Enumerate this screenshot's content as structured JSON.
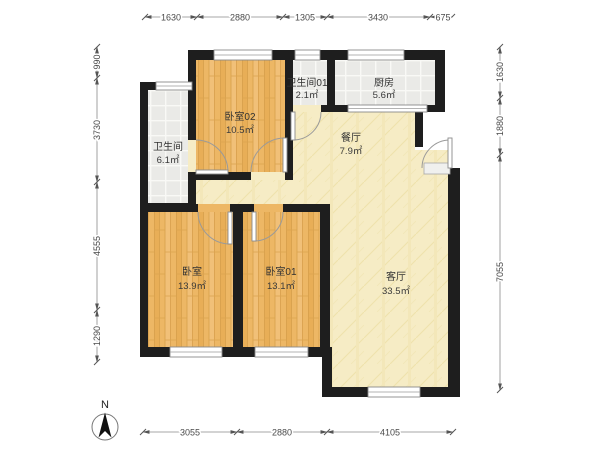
{
  "title": "floor-plan",
  "compass": {
    "label": "N"
  },
  "rooms": {
    "bedroom02": {
      "name": "卧室02",
      "area": "10.5㎡"
    },
    "bathroom01": {
      "name": "卫生间01",
      "area": "2.1㎡"
    },
    "kitchen": {
      "name": "厨房",
      "area": "5.6㎡"
    },
    "dining": {
      "name": "餐厅",
      "area": "7.9㎡"
    },
    "bathroom": {
      "name": "卫生间",
      "area": "6.1㎡"
    },
    "bedroom": {
      "name": "卧室",
      "area": "13.9㎡"
    },
    "bedroom01": {
      "name": "卧室01",
      "area": "13.1㎡"
    },
    "living": {
      "name": "客厅",
      "area": "33.5㎡"
    }
  },
  "dimensions": {
    "top": [
      "1630",
      "2880",
      "1305",
      "3430",
      "675"
    ],
    "left": [
      "990",
      "3730",
      "4555",
      "1290"
    ],
    "right": [
      "1630",
      "1880",
      "7055"
    ],
    "bottom": [
      "3055",
      "2880",
      "4105"
    ]
  },
  "colors": {
    "wall": "#1e1e1e",
    "wood_floor": "#edb765",
    "cream_floor": "#f6ecc5",
    "tile_floor": "#eaeae7",
    "dim_text": "#4a4a4a"
  }
}
